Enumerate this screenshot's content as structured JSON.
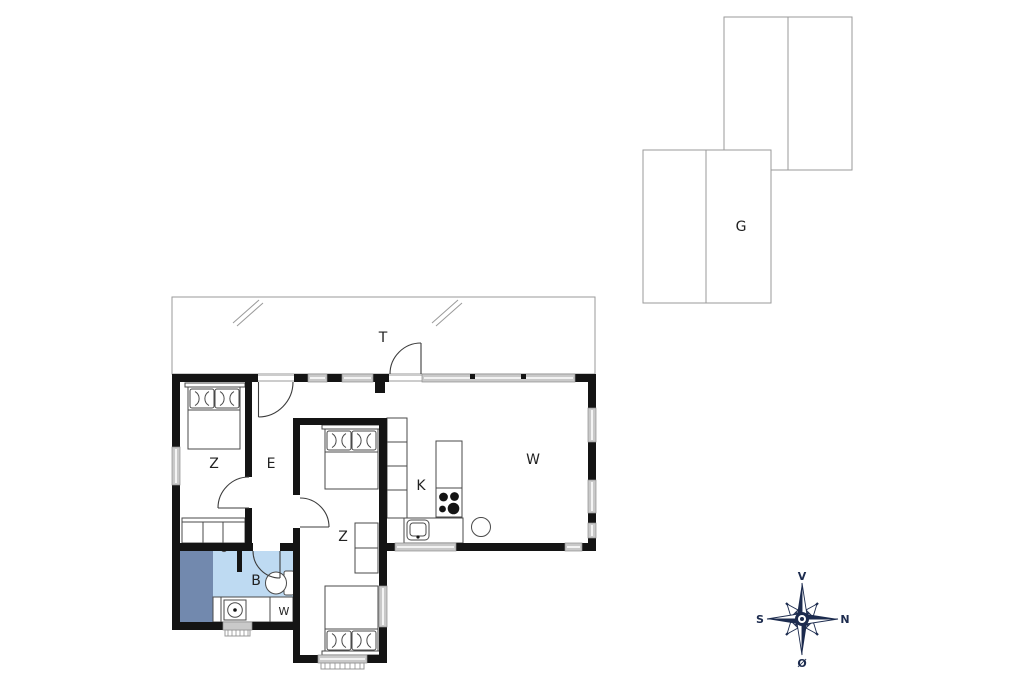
{
  "figure": "house-floor-plan",
  "rooms": {
    "terrace": {
      "label": "T"
    },
    "bedroom_top_left": {
      "label": "Z"
    },
    "hall": {
      "label": "E"
    },
    "bedroom_middle": {
      "label": "Z"
    },
    "kitchen": {
      "label": "K"
    },
    "living_room": {
      "label": "W"
    },
    "bathroom": {
      "label": "B"
    },
    "utility": {
      "label": "W"
    },
    "garage": {
      "label": "G"
    }
  },
  "compass": {
    "up": "V",
    "right": "N",
    "left": "S",
    "down": "Ø"
  },
  "colors": {
    "wall": "#141414",
    "window": "#c9c9c9",
    "window_frame": "#8e8e8e",
    "bath_floor": "#bedaf2",
    "shower_floor": "#7289ae",
    "outline": "#9a9a9a",
    "furniture_line": "#4a4a4a",
    "compass": "#1c2b4e",
    "label": "#222222",
    "background": "#ffffff"
  }
}
